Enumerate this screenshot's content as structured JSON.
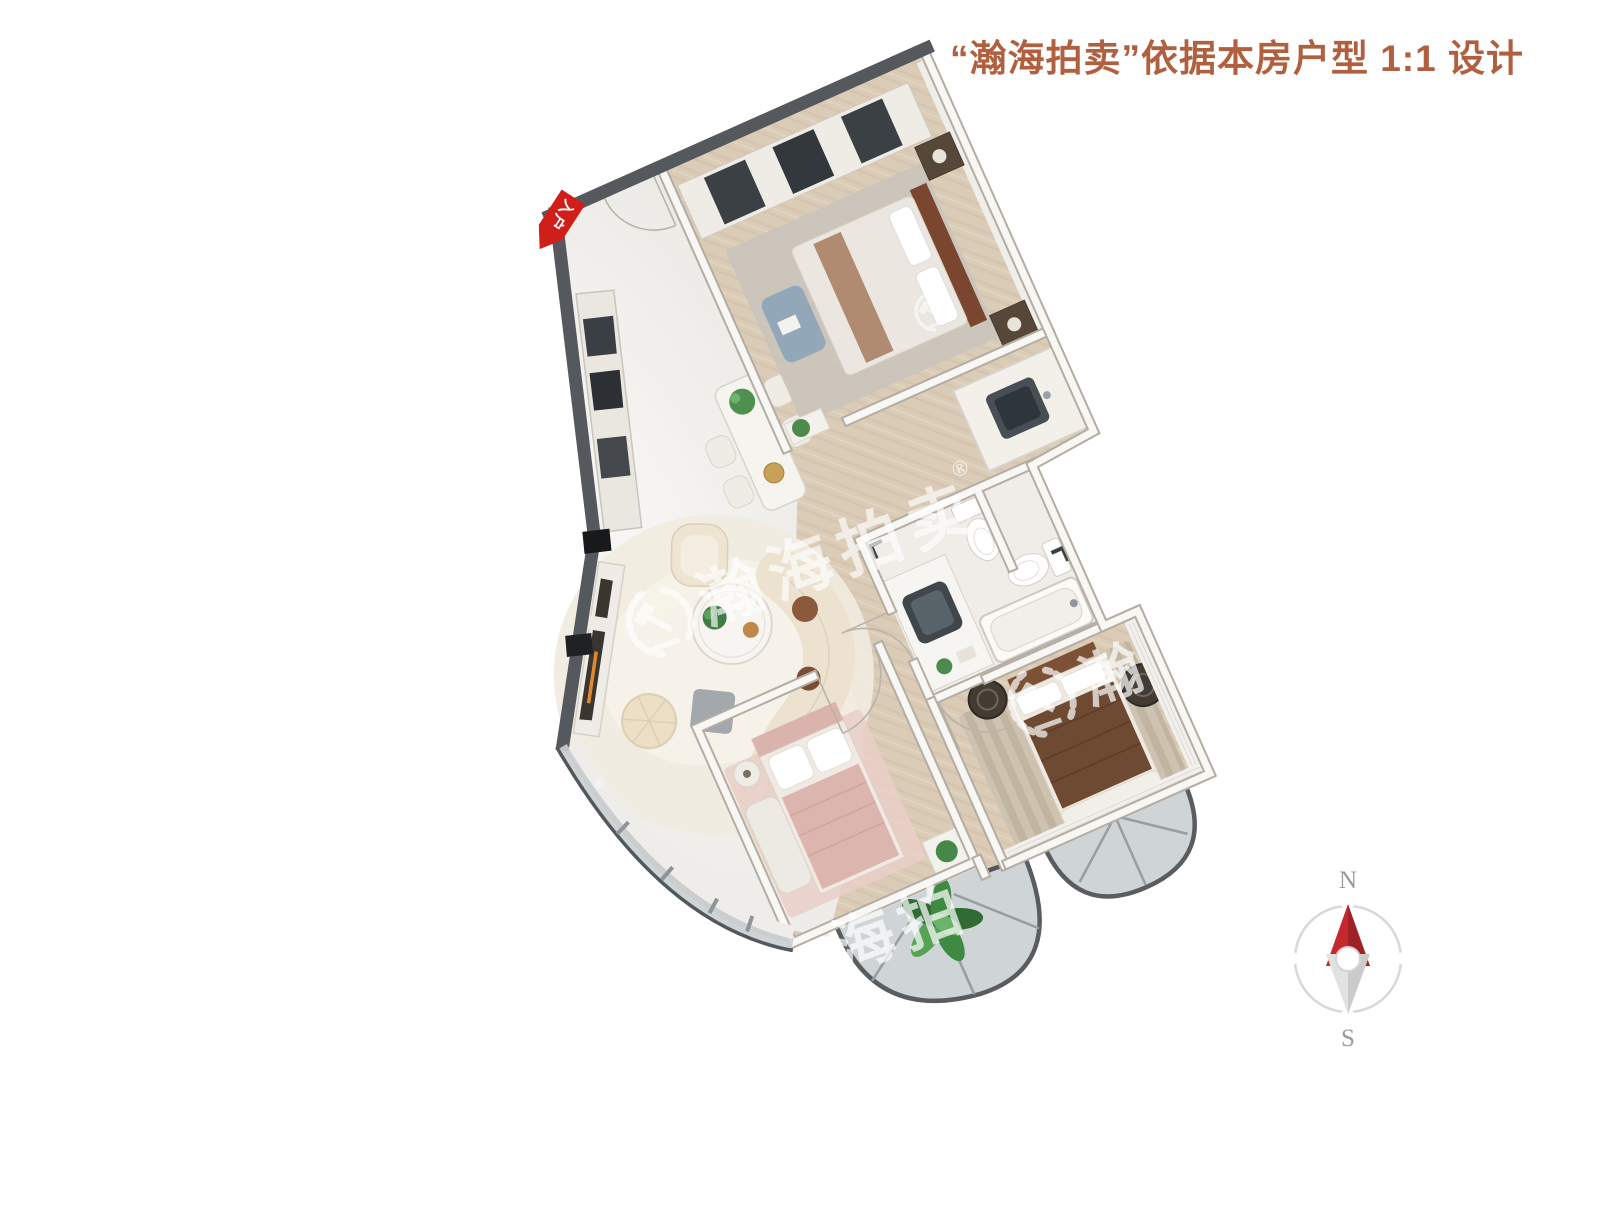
{
  "header": {
    "title": "“瀚海拍卖”依据本房户型 1:1 设计"
  },
  "plan": {
    "entry_label": "入户"
  },
  "watermark": {
    "brand": "瀚海拍卖",
    "registered": "®",
    "partial_right": "瀚",
    "partial_bottom": "海拍"
  },
  "compass": {
    "north_label": "N",
    "south_label": "S"
  },
  "colors": {
    "header_text": "#b0603e",
    "entry_arrow_red": "#d01f1a",
    "compass_north_red": "#c5282d",
    "dark_wall": "#55595d",
    "wood_floor": "#dbccb7",
    "marble_floor": "#f2f1ee",
    "balcony_glass": "#c9cfd2",
    "cream_sofa": "#ece2cf",
    "pink_bed": "#dcb6ae",
    "brown_bed": "#6e4a33",
    "blue_bench": "#92a7b8"
  }
}
